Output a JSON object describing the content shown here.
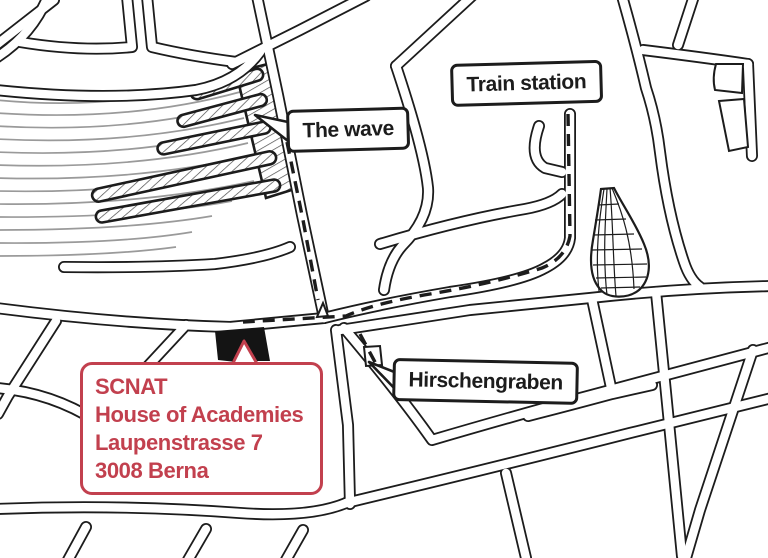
{
  "labels": {
    "the_wave": "The wave",
    "train_station": "Train station",
    "hirschengraben": "Hirschengraben"
  },
  "address_card": {
    "line1": "SCNAT",
    "line2": "House of Academies",
    "line3": "Laupenstrasse 7",
    "line4": "3008 Berna"
  },
  "colors": {
    "ink": "#1c1c1c",
    "rail": "#9a9a9a",
    "accent": "#c2404e",
    "building": "#141414",
    "paper": "#ffffff"
  }
}
